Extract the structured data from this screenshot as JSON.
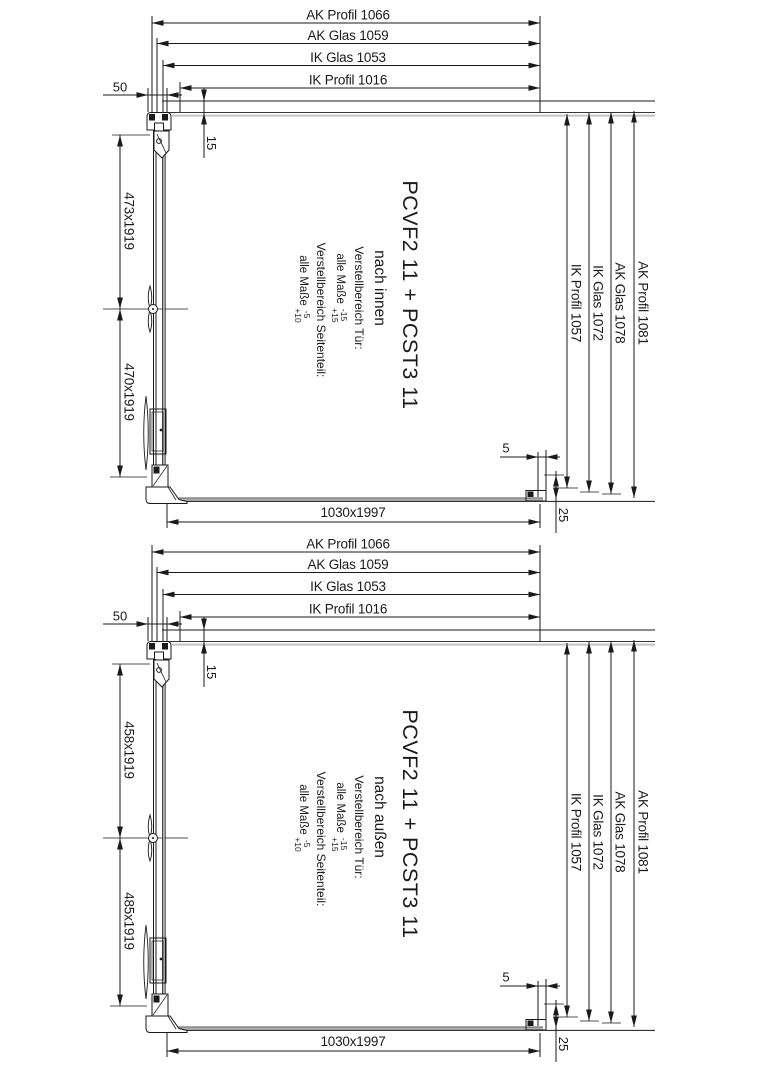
{
  "colors": {
    "line": "#1a1a1a",
    "glass_gray": "#b0b0b0",
    "background": "#ffffff"
  },
  "drawings": [
    {
      "top_dims": [
        "AK Profil 1066",
        "AK Glas 1059",
        "IK Glas 1053",
        "IK Profil 1016"
      ],
      "right_dims": [
        "IK Profil 1057",
        "IK Glas 1072",
        "AK Glas 1078",
        "AK Profil 1081"
      ],
      "left_dims": [
        "473x1919",
        "470x1919"
      ],
      "bottom_dim": "1030x1997",
      "offsets": {
        "wall": "50",
        "top": "15",
        "gap": "5",
        "bottom": "25"
      },
      "center": {
        "title": "PCVF2 11 + PCST3 11",
        "direction": "nach innen",
        "door_label": "Verstellbereich Tür:",
        "door_value": "alle Maße",
        "door_minus": "-15",
        "door_plus": "+15",
        "side_label": "Verstellbereich Seitenteil:",
        "side_value": "alle Maße",
        "side_minus": "-5",
        "side_plus": "+10"
      }
    },
    {
      "top_dims": [
        "AK Profil 1066",
        "AK Glas 1059",
        "IK Glas 1053",
        "IK Profil 1016"
      ],
      "right_dims": [
        "IK Profil 1057",
        "IK Glas 1072",
        "AK Glas 1078",
        "AK Profil 1081"
      ],
      "left_dims": [
        "458x1919",
        "485x1919"
      ],
      "bottom_dim": "1030x1997",
      "offsets": {
        "wall": "50",
        "top": "15",
        "gap": "5",
        "bottom": "25"
      },
      "center": {
        "title": "PCVF2 11 + PCST3 11",
        "direction": "nach außen",
        "door_label": "Verstellbereich Tür:",
        "door_value": "alle Maße",
        "door_minus": "-15",
        "door_plus": "+15",
        "side_label": "Verstellbereich Seitenteil:",
        "side_value": "alle Maße",
        "side_minus": "-5",
        "side_plus": "+10"
      }
    }
  ]
}
